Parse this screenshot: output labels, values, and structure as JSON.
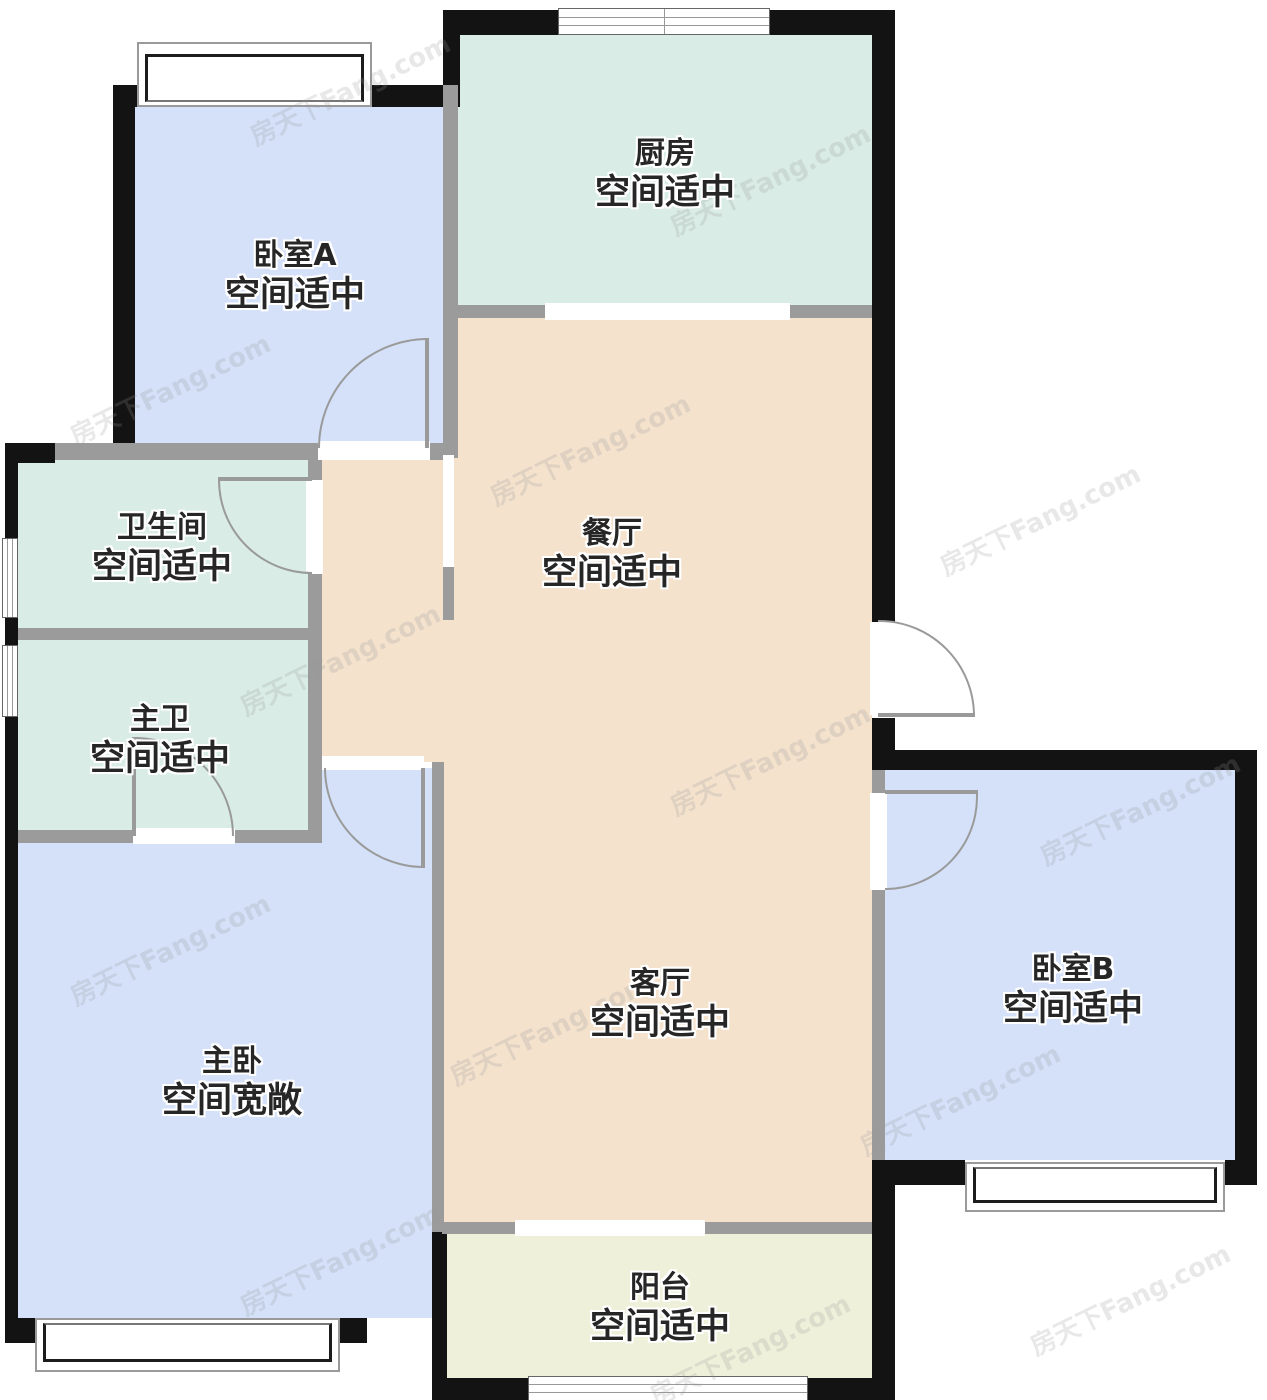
{
  "watermark": "房天下Fang.com",
  "rooms": {
    "kitchen": {
      "name": "厨房",
      "status": "空间适中"
    },
    "bedroomA": {
      "name": "卧室A",
      "status": "空间适中"
    },
    "bathroom": {
      "name": "卫生间",
      "status": "空间适中"
    },
    "masterBath": {
      "name": "主卫",
      "status": "空间适中"
    },
    "dining": {
      "name": "餐厅",
      "status": "空间适中"
    },
    "living": {
      "name": "客厅",
      "status": "空间适中"
    },
    "masterBedroom": {
      "name": "主卧",
      "status": "空间宽敞"
    },
    "bedroomB": {
      "name": "卧室B",
      "status": "空间适中"
    },
    "balcony": {
      "name": "阳台",
      "status": "空间适中"
    }
  },
  "colors": {
    "bedroom": "#d4e1f9",
    "wet": "#d9ece5",
    "hall": "#f4e2cd",
    "balcony": "#eff0da",
    "wall": "#131313",
    "innerWall": "#9b9b9b"
  }
}
